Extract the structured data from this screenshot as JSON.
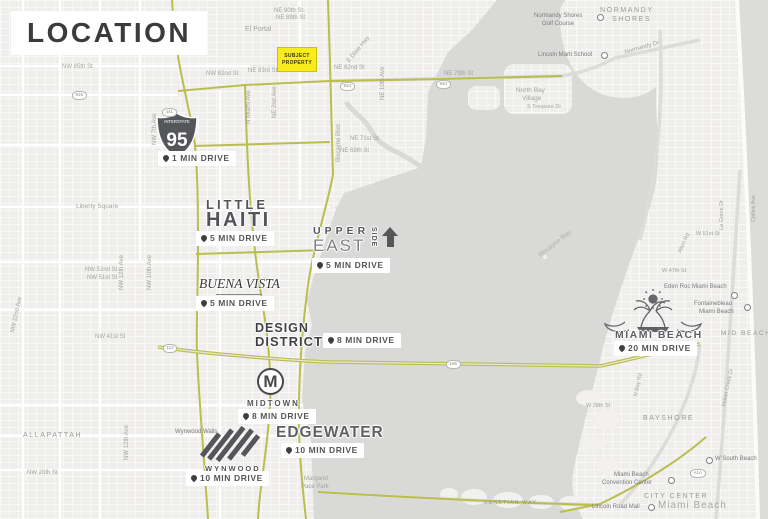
{
  "title": "LOCATION",
  "subject_property": {
    "line1": "SUBJECT",
    "line2": "PROPERTY"
  },
  "interstate": {
    "banner": "INTERSTATE",
    "number": "95"
  },
  "logos": {
    "little_haiti": {
      "line1": "LITTLE",
      "line2": "HAITI"
    },
    "buena_vista": {
      "name": "BUENA VISTA"
    },
    "upper_east_side": {
      "word1": "UPPER",
      "word2": "EAST",
      "word3": "SIDE"
    },
    "design_district": {
      "line1": "DESIGN",
      "line2": "DISTRICT"
    },
    "midtown": {
      "initial": "M",
      "name": "MIDTOWN"
    },
    "edgewater": {
      "name": "EDGEWATER"
    },
    "wynwood": {
      "name": "WYNWOOD"
    },
    "miami_beach": {
      "name": "MIAMI BEACH"
    }
  },
  "drive_times": [
    {
      "area": "I-95",
      "label": "1 MIN DRIVE"
    },
    {
      "area": "Little Haiti",
      "label": "5 MIN DRIVE"
    },
    {
      "area": "Upper East Side",
      "label": "5 MIN DRIVE"
    },
    {
      "area": "Buena Vista",
      "label": "5 MIN DRIVE"
    },
    {
      "area": "Design District",
      "label": "8 MIN DRIVE"
    },
    {
      "area": "Midtown",
      "label": "8 MIN DRIVE"
    },
    {
      "area": "Edgewater",
      "label": "10 MIN DRIVE"
    },
    {
      "area": "Wynwood",
      "label": "10 MIN DRIVE"
    },
    {
      "area": "Miami Beach",
      "label": "20 MIN DRIVE"
    }
  ],
  "neighborhoods": {
    "el_portal": "El Portal",
    "liberty_square": "Liberty Square",
    "allapattah": "ALLAPATTAH",
    "normandy_1": "NORMANDY",
    "normandy_2": "SHORES",
    "north_bay_1": "North Bay",
    "north_bay_2": "Village",
    "bayshore": "BAYSHORE",
    "city_center": "CITY CENTER",
    "mid_beach": "MID BEACH",
    "miami_beach_area": "Miami Beach",
    "biscayne_bay": "Biscayne Bay",
    "venetian_way": "VENETIAN WAY"
  },
  "pois": {
    "golf_1": "Normandy Shores",
    "golf_2": "Golf Course",
    "lincoln_marti": "Lincoln Marti School",
    "wynwood_walls": "Wynwood Walls",
    "margaret_pace_1": "Margaret",
    "margaret_pace_2": "Pace Park",
    "eden_roc": "Eden Roc Miami Beach",
    "fontainebleau_1": "Fontainebleau",
    "fontainebleau_2": "Miami Beach",
    "w_south_beach": "W South Beach",
    "convention_1": "Miami Beach",
    "convention_2": "Convention Center",
    "lincoln_road": "Lincoln Road Mall"
  },
  "streets": {
    "ne90": "NE 90th St",
    "ne89": "NE 89th St",
    "ne83": "NE 83rd St",
    "ne82": "NE 82nd St",
    "ne79": "NE 79th St",
    "ne71": "NE 71st St",
    "ne69": "NE 69th St",
    "ne2av": "NE 2nd Ave",
    "nmiami": "N Miami Ave",
    "biscayne_blvd": "Biscayne Blvd",
    "ne10av": "NE 10th Ave",
    "dixie": "E Dixie Hwy",
    "nw85": "NW 85th St",
    "nw82": "NW 82nd St",
    "nw7av": "NW 7th Ave",
    "nw12av": "NW 12th Ave",
    "nw10av": "NW 10th Ave",
    "nw52": "NW 52nd St",
    "nw51": "NW 51st St",
    "nw41": "NW 41st St",
    "nw22av": "NW 22nd Ave",
    "nw20": "NW 20th St",
    "nw12av2": "NW 12th Ave",
    "streasure": "S Treasure Dr",
    "normandy_dr": "Normandy Dr",
    "w51": "W 51st St",
    "w47": "W 47th St",
    "alton": "Alton Rd",
    "lagorce": "La Gorce Dr",
    "collins": "Collins Ave",
    "indian": "Indian Creek Dr",
    "nbay": "N Bay Rd",
    "w28": "W 28th St"
  },
  "shields": {
    "s916": "916",
    "s441": "441",
    "s934a": "934",
    "s934b": "934",
    "s112": "112",
    "s195": "195",
    "a1a": "A1A"
  },
  "colors": {
    "route": "#b9be4e",
    "water": "#d9d9d7",
    "land": "#efeeec",
    "subject_yellow": "#f8ec1c",
    "logo_dark": "#53545a",
    "label_gray": "#a3a3a1"
  }
}
